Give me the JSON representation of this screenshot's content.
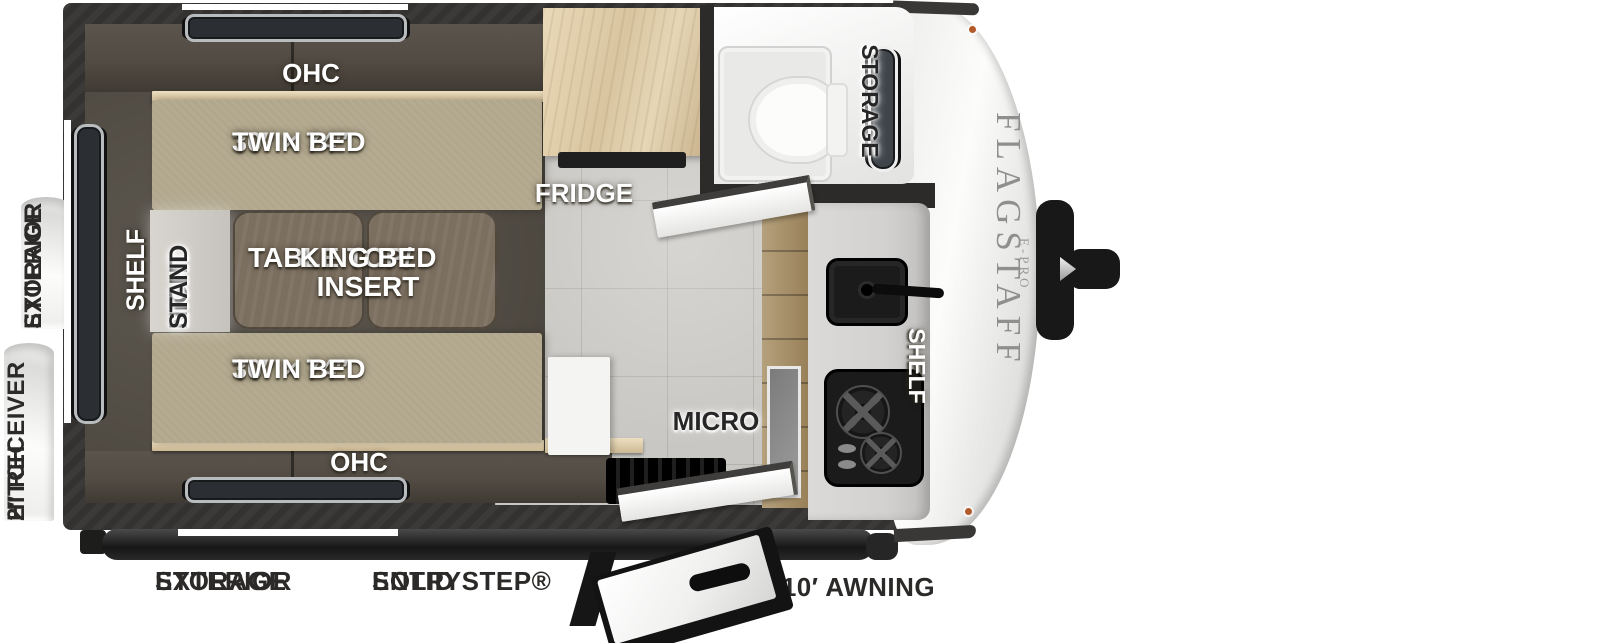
{
  "side_labels": {
    "exterior_storage": {
      "line1": "EXTERIOR",
      "line2": "STORAGE"
    },
    "receiver_hitch": {
      "line1": "2″ RECEIVER",
      "line2": "HITCH"
    }
  },
  "interior": {
    "ohc_top": "OHC",
    "ohc_bottom": "OHC",
    "twin_bed_top": {
      "line1": "30″ × 74″",
      "line2": "TWIN BED"
    },
    "twin_bed_bottom": {
      "line1": "30″ × 74″",
      "line2": "TWIN BED"
    },
    "table": {
      "line1": "TABLE TOP/",
      "line2": "KING BED INSERT"
    },
    "shelf_bedroom": "SHELF",
    "night_stand": {
      "line1": "NIGHT",
      "line2": "STAND"
    },
    "fridge": "FRIDGE",
    "bathroom_storage": "STORAGE",
    "micro": "MICRO",
    "shelf_kitchen": "SHELF"
  },
  "exterior": {
    "brand": "FLAGSTAFF",
    "brand_sub": "E-PRO"
  },
  "bottom_labels": {
    "exterior_storage": {
      "line1": "EXTERIOR",
      "line2": "STORAGE"
    },
    "solid_step": {
      "line1": "SOLID STEP®",
      "line2": "ENTRY"
    },
    "awning": "10′ AWNING"
  },
  "colors": {
    "wall_dark": "#343230",
    "interior_dark": "#55504a",
    "bed_beige": "#b1a78d",
    "wood_trim": "#d9c9a7",
    "table_brown": "#7b6f60",
    "night_stand_gray": "#cfccc6",
    "floor_tile": "#c9c7c3",
    "fridge_wood": "#e3d3b0",
    "pantry_wood": "#a8956f",
    "appliance_black": "#1b1b1b",
    "bathroom_white": "#f4f4f3",
    "front_cap_white": "#f6f6f5",
    "brand_text_gray": "#8f8f8f",
    "label_white": "#ffffff",
    "label_black": "#262626"
  }
}
